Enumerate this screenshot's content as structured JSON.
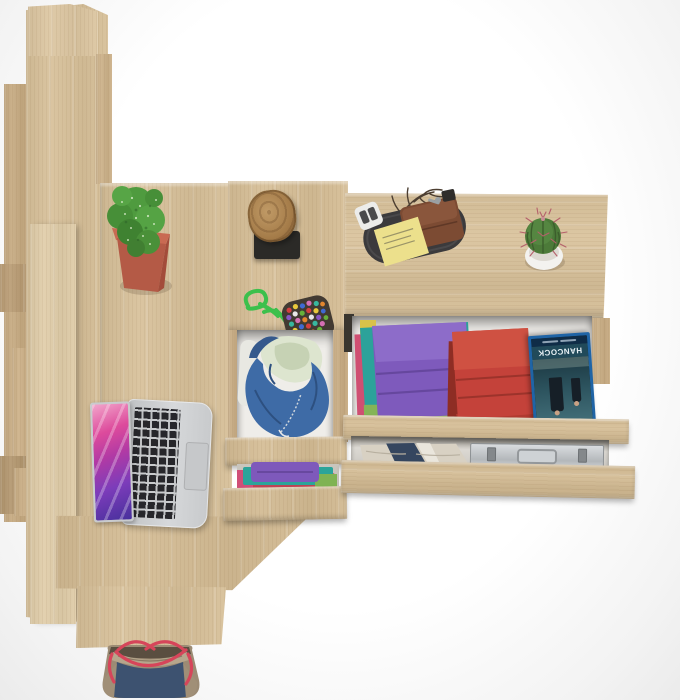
{
  "window": {
    "width": 680,
    "height": 700
  },
  "scene": {
    "type": "3d-product-render-top-view",
    "description": "Overhead view of a light Sonoma-oak furniture set: tall wardrobe unit on the left, desk with open laptop and a succulent in a red pot, a narrow chest with open drawers holding a blue hoodie and folded clothes, and a wide dresser with open drawers containing folded clothes, a Blu-ray case and an aluminum briefcase; a log stool, bead keychain, valet tray with wallet, cactus, and a tote bag on the floor.",
    "background_color": "#f5f5f5"
  },
  "palette": {
    "wood_base": "#d7c099",
    "wood_light": "#e0cda9",
    "wood_medium": "#c6aa81",
    "wood_dark": "#b2966e",
    "drawer_interior": "#efede9"
  },
  "objects": {
    "wardrobe_unit": {
      "label": "tall oak wardrobe / shelf unit seen from above"
    },
    "desk": {
      "label": "oak desk surface"
    },
    "succulent_plant": {
      "label": "succulent in square planter",
      "pot_color": "#b95b47",
      "foliage_color": "#4f9b3f"
    },
    "log_stool": {
      "label": "log-top stool on dark base",
      "seat_color": "#a87e4d",
      "base_color": "#2b2a27"
    },
    "bead_keychain": {
      "label": "green paracord keychain with bead pad",
      "cord_color": "#3cc04c",
      "bead_colors": [
        "#d33f3f",
        "#e9c93c",
        "#3f6ad3",
        "#d56fb4",
        "#38b79e",
        "#e2862f",
        "#8857c4",
        "#e8e8e8",
        "#67b13a"
      ]
    },
    "valet_tray": {
      "label": "dark oval valet tray",
      "tray_color": "#3b3a3c",
      "items": [
        "brown leather wallet",
        "yellow sticky note",
        "white glasses",
        "key with black fob",
        "decorative twig"
      ]
    },
    "cactus": {
      "label": "round cactus in white pot",
      "pot_color": "#f3f2ef",
      "body_color": "#4c7a39",
      "spine_color": "#b5606b"
    },
    "laptop": {
      "label": "open silver laptop, top view",
      "screen_wallpaper": "pink-purple abstract",
      "key_color": "#27272b"
    },
    "chest_drawers": {
      "label": "narrow chest with two open drawers",
      "drawer1_contents": "blue zip hoodie with cream lining over white shirt",
      "drawer2_contents": [
        "purple",
        "teal",
        "red",
        "green",
        "pink folded clothes"
      ]
    },
    "dresser": {
      "label": "wide dresser with two open drawers",
      "drawer1_left_stack": [
        "purple",
        "teal",
        "pink",
        "green",
        "yellow"
      ],
      "drawer1_right_stack": [
        "red"
      ],
      "drawer2_contents": [
        "beige garment with navy strap",
        "aluminum briefcase"
      ]
    },
    "bluray": {
      "title_text": "HANCOCK",
      "case_color": "#1f64a6",
      "orientation": "upside-down"
    },
    "tote_bag": {
      "label": "tote bag on floor",
      "body_colors": [
        "taupe",
        "navy"
      ],
      "strap_color": "#d6455a"
    }
  }
}
